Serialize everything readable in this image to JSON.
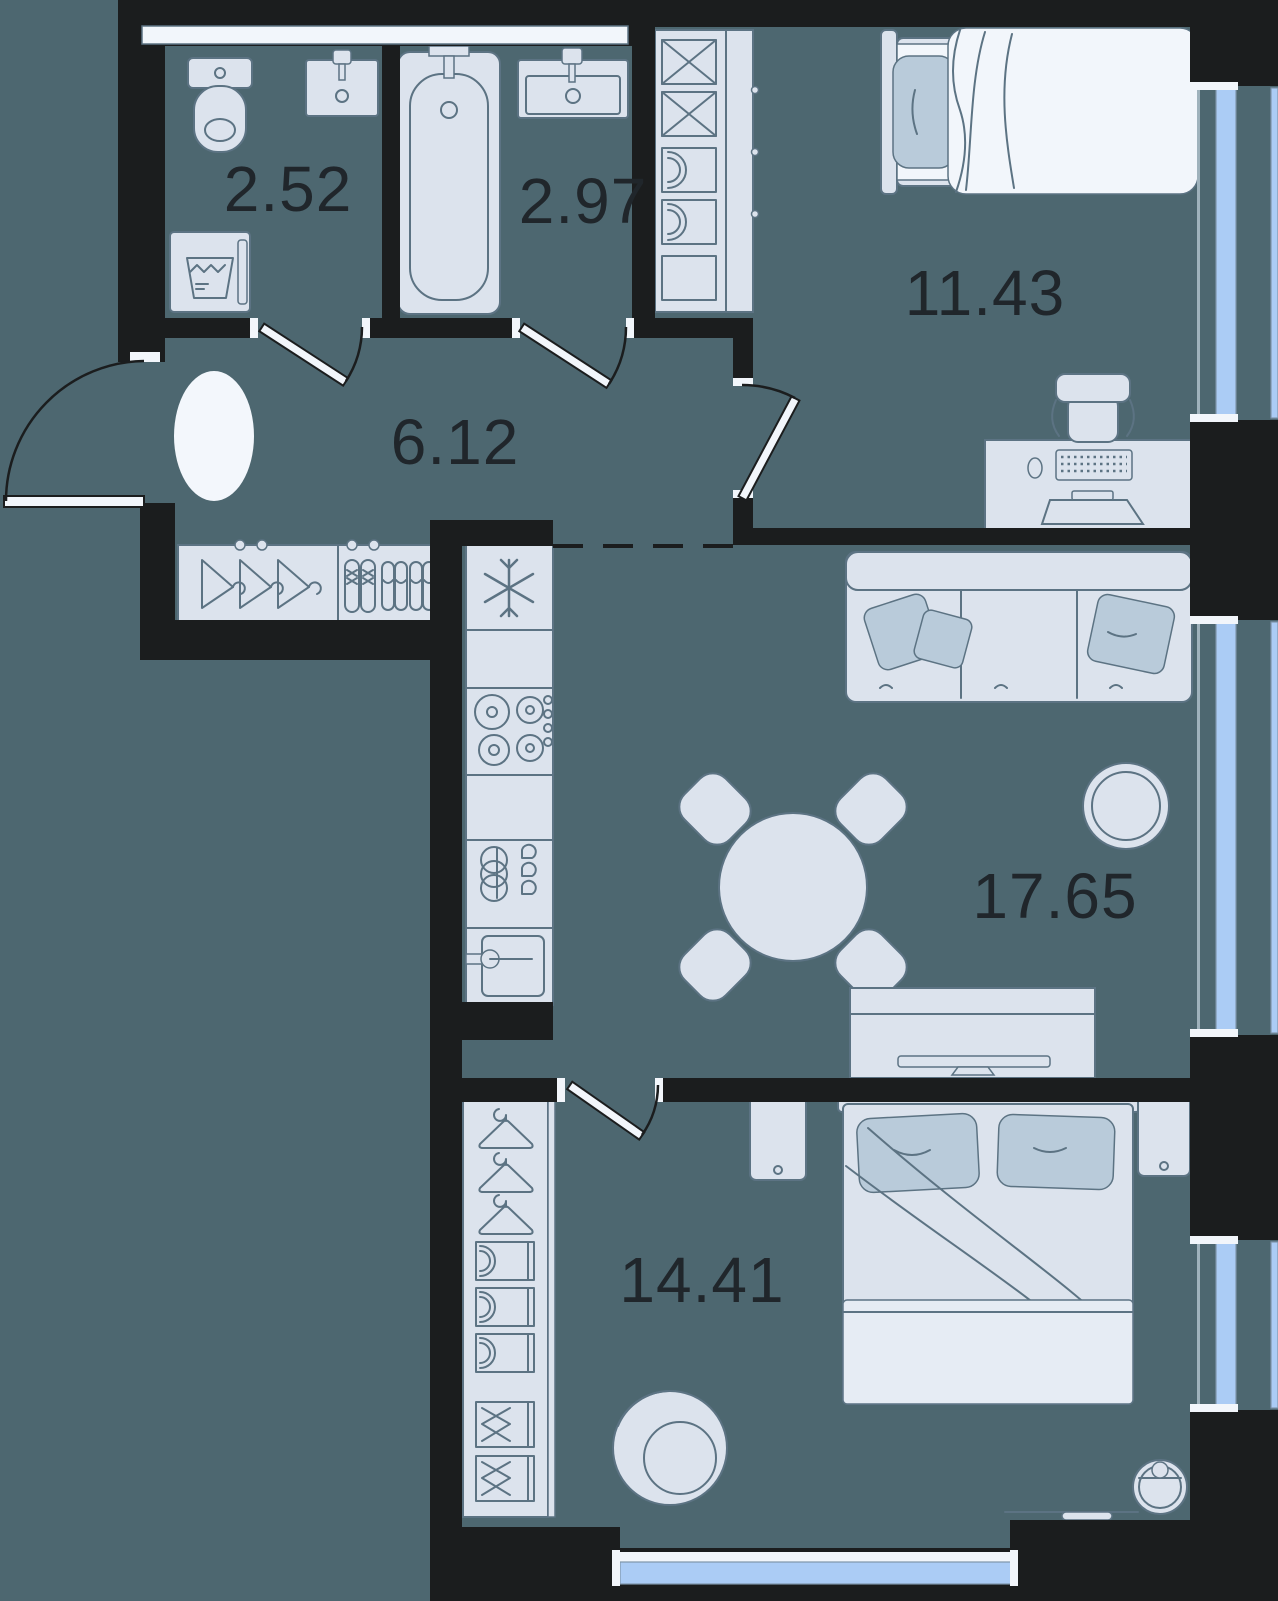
{
  "plan": {
    "type": "apartment-floor-plan",
    "rooms": [
      {
        "id": "wc",
        "area": "2.52"
      },
      {
        "id": "bathroom",
        "area": "2.97"
      },
      {
        "id": "hallway",
        "area": "6.12"
      },
      {
        "id": "bedroom",
        "area": "11.43"
      },
      {
        "id": "living-kitchen",
        "area": "17.65"
      },
      {
        "id": "bedroom-2",
        "area": "14.41"
      }
    ],
    "colors": {
      "floor": "#4d6770",
      "wall": "#1b1d1e",
      "furniture-fill": "#dce3ed",
      "furniture-stroke": "#5c7383",
      "textile-accent": "#b9cbda",
      "window-glass": "#abccf5",
      "highlight-white": "#f2f6fb",
      "label-text": "#20262b"
    },
    "fixtures": [
      "toilet",
      "wall-sink",
      "washing-machine",
      "bathtub",
      "bathroom-sink",
      "linen-shelves",
      "entrance-door",
      "interior-doors",
      "hallway-rug",
      "hallway-wardrobe-hangers",
      "shoes",
      "refrigerator",
      "cooktop",
      "kitchen-cabinet",
      "kitchen-sink",
      "single-bed",
      "desk",
      "desk-chair",
      "monitor",
      "keyboard",
      "mouse",
      "sofa",
      "throw-pillows",
      "coffee-table",
      "dining-table",
      "dining-chairs",
      "tv-stand",
      "double-bed",
      "nightstands",
      "wardrobe-with-hangers",
      "armchair",
      "robot-vacuum",
      "windows"
    ]
  }
}
